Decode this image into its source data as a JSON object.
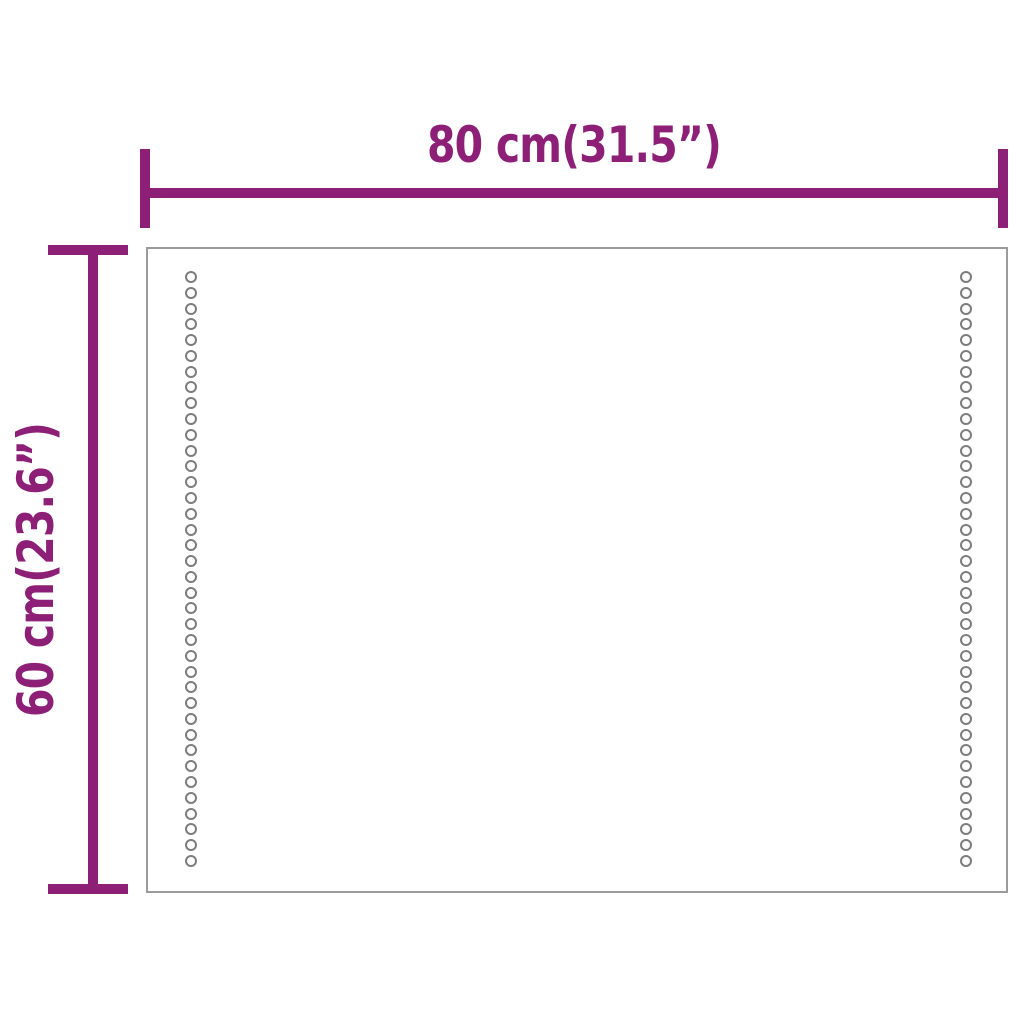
{
  "diagram": {
    "type": "product-dimension-diagram",
    "dimensions": {
      "width": {
        "label": "80 cm(31.5”)",
        "orientation": "horizontal"
      },
      "height": {
        "label": "60 cm(23.6”)",
        "orientation": "vertical-rotated"
      }
    },
    "panel": {
      "shape": "rectangle",
      "led_dot_columns": 2,
      "dots_per_column": 38
    },
    "colors": {
      "dimension": "#8D1F76",
      "panel_border": "#9B9B9B",
      "dot_ring": "#7D7D7D",
      "background": "#FFFFFF"
    }
  }
}
